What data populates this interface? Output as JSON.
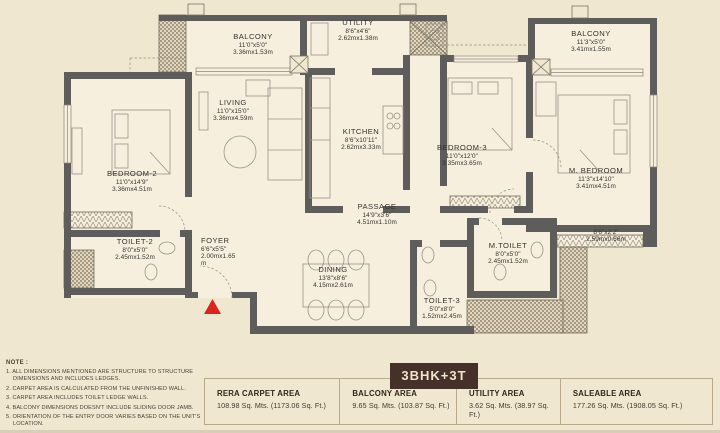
{
  "plan": {
    "rooms": {
      "balcony_left": {
        "name": "BALCONY",
        "dims_ft": "11'0\"x5'0\"",
        "dims_m": "3.36mx1.53m"
      },
      "utility": {
        "name": "UTILITY",
        "dims_ft": "8'6\"x4'6\"",
        "dims_m": "2.62mx1.38m"
      },
      "balcony_right": {
        "name": "BALCONY",
        "dims_ft": "11'3\"x5'0\"",
        "dims_m": "3.41mx1.55m"
      },
      "living": {
        "name": "LIVING",
        "dims_ft": "11'0\"x15'0\"",
        "dims_m": "3.36mx4.59m"
      },
      "kitchen": {
        "name": "KITCHEN",
        "dims_ft": "8'6\"x10'11\"",
        "dims_m": "2.62mx3.33m"
      },
      "bedroom3": {
        "name": "BEDROOM-3",
        "dims_ft": "11'0\"x12'0\"",
        "dims_m": "3.35mx3.65m"
      },
      "m_bedroom": {
        "name": "M. BEDROOM",
        "dims_ft": "11'3\"x14'10\"",
        "dims_m": "3.41mx4.51m"
      },
      "bedroom2": {
        "name": "BEDROOM-2",
        "dims_ft": "11'0\"x14'9\"",
        "dims_m": "3.36mx4.51m"
      },
      "passage": {
        "name": "PASSAGE",
        "dims_ft": "14'9\"x3'6\"",
        "dims_m": "4.51mx1.10m"
      },
      "toilet2": {
        "name": "TOILET-2",
        "dims_ft": "8'0\"x5'0\"",
        "dims_m": "2.45mx1.52m"
      },
      "foyer": {
        "name": "FOYER",
        "dims_ft": "6'6\"x5'5\"",
        "dims_m": "2.00mx1.65",
        "dims_m2": "m"
      },
      "dining": {
        "name": "DINING",
        "dims_ft": "13'8\"x8'6\"",
        "dims_m": "4.15mx2.61m"
      },
      "m_toilet": {
        "name": "M.TOILET",
        "dims_ft": "8'0\"x5'0\"",
        "dims_m": "2.45mx1.52m"
      },
      "toilet3": {
        "name": "TOILET-3",
        "dims_ft": "5'0\"x8'0\"",
        "dims_m": "1.52mx2.45m"
      },
      "deck_ledge": {
        "name": "",
        "dims_ft": "8'6\"x2'2\"",
        "dims_m": "2.59mx0.66m"
      }
    }
  },
  "notes": {
    "title": "NOTE :",
    "items": [
      "1. ALL DIMENSIONS MENTIONED ARE STRUCTURE TO STRUCTURE DIMENSIONS AND INCLUDES LEDGES.",
      "2. CARPET AREA IS CALCULATED FROM THE UNFINISHED WALL.",
      "3. CARPET AREA INCLUDES TOILET LEDGE WALLS.",
      "4. BALCONY DIMENSIONS DOESN'T INCLUDE SLIDING DOOR JAMB.",
      "5. ORIENTATION OF THE ENTRY DOOR VARIES BASED ON THE UNIT'S LOCATION."
    ]
  },
  "summary": {
    "unit_type": "3BHK+3T",
    "areas": [
      {
        "label": "RERA CARPET AREA",
        "value": "108.98 Sq. Mts. (1173.06 Sq. Ft.)"
      },
      {
        "label": "BALCONY AREA",
        "value": "9.65 Sq. Mts. (103.87 Sq. Ft.)"
      },
      {
        "label": "UTILITY AREA",
        "value": "3.62 Sq. Mts. (38.97 Sq. Ft.)"
      },
      {
        "label": "SALEABLE AREA",
        "value": "177.26 Sq. Mts. (1908.05 Sq. Ft.)"
      }
    ]
  },
  "colors": {
    "background": "#f0e7d1",
    "room_fill": "#f6efde",
    "wall": "#5e5d5b",
    "entry_marker": "#da251d",
    "badge_bg": "#46302a",
    "badge_text": "#f0e4cb",
    "table_border": "#b9aa8c"
  }
}
